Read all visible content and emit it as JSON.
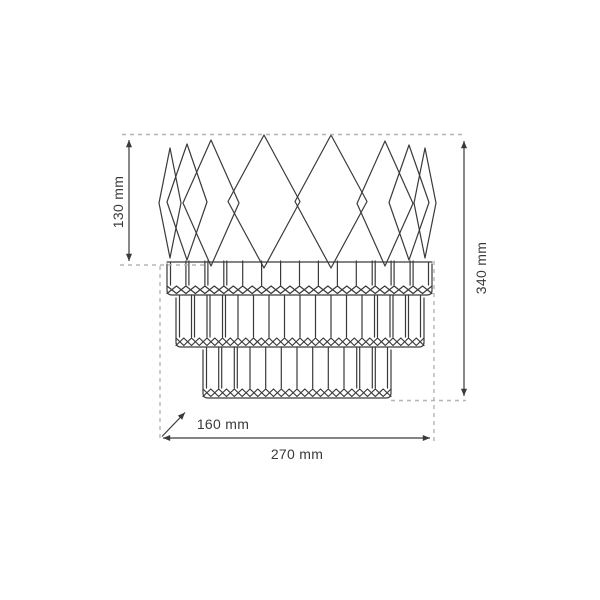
{
  "canvas": {
    "background": "#ffffff",
    "line_color": "#3a3a3a",
    "dash_color": "#b5b5b5"
  },
  "diagram": {
    "subject": "three-tier crystal lamp technical line drawing",
    "labels": {
      "crown_height": "130 mm",
      "total_height": "340 mm",
      "depth": "160 mm",
      "width": "270 mm"
    }
  }
}
